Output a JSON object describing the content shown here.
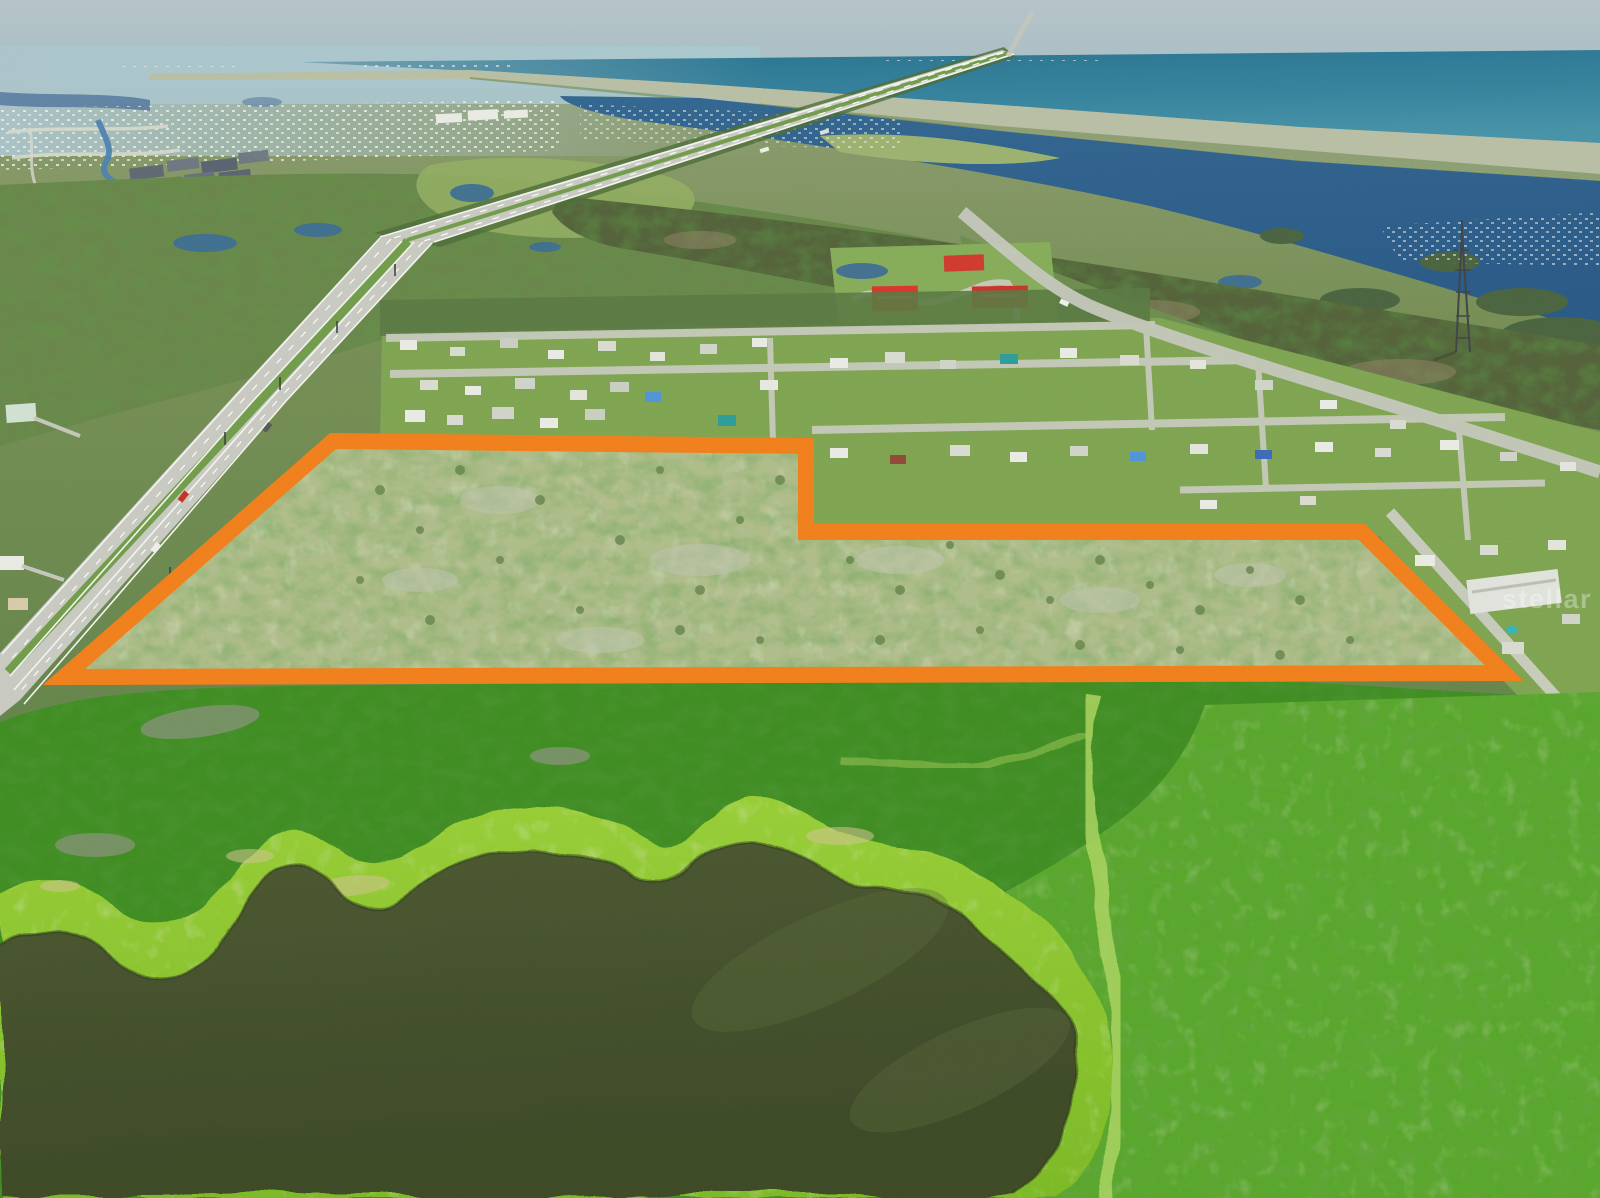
{
  "photo": {
    "kind": "aerial-drone-photograph",
    "subject": "vacant land parcel outlined in orange near coastal suburb, lagoon, barrier island and ocean, with a green pond in the foreground"
  },
  "boundary": {
    "points": "333,441 806,446 806,532 1362,532 1504,673 64,677",
    "stroke_color": "#F07D1D",
    "stroke_width": "16",
    "fill_overlay": "#FFFFFF",
    "fill_overlay_opacity": "0.08"
  },
  "watermark": {
    "text": "stellar MLS",
    "color": "#FFFFFF",
    "opacity": "0.33"
  },
  "palette": {
    "sky_haze": "#A9BCC3",
    "ocean": "#2B7591",
    "lagoon": "#2E5F8A",
    "barrier_island": "#B6BDA2",
    "distant_land": "#8A9B70",
    "forest": "#68834A",
    "mangrove": "#53603A",
    "park_lawn": "#83AA58",
    "red_roof": "#D7372C",
    "red_roof_dark": "#C9332A",
    "red_roof_small": "#CF3A2E",
    "road": "#C7C9C1",
    "median_grass": "#6F9A4A",
    "subdivision_lawn": "#7CA250",
    "parcel_scrub": "#A7B67E",
    "foreground_forest": "#3F8A22",
    "lake_bank": "#8BC530",
    "lake_water": "#46512E",
    "shrubland": "#57A42C",
    "trail": "#A8D35E",
    "canal": "#4D7FAE",
    "pond": "#3E6B90"
  }
}
